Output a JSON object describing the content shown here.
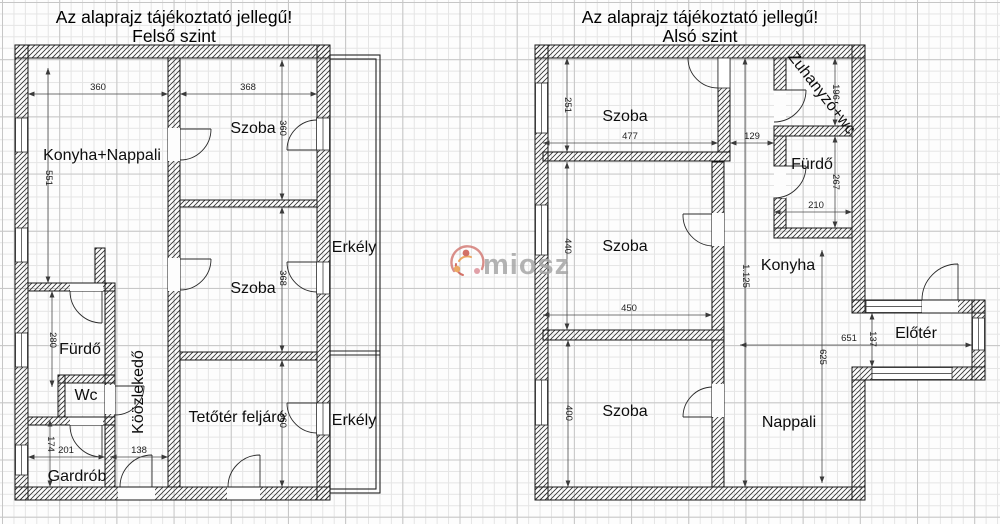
{
  "upper": {
    "disclaimer": "Az alaprajz tájékoztató jellegű!",
    "level": "Felső szint",
    "rooms": {
      "konyha_nappali": "Konyha+Nappali",
      "szoba_top": "Szoba",
      "szoba_mid": "Szoba",
      "erkely_top": "Erkély",
      "erkely_bottom": "Erkély",
      "furdo": "Fürdő",
      "wc": "Wc",
      "kozlekedo": "Köözlekedő",
      "tetoter": "Tetőtér feljáró",
      "gardrob": "Gardrób"
    },
    "dims": {
      "konyha_w": "360",
      "szoba_top_w": "368",
      "konyha_h": "551",
      "szoba_top_h": "360",
      "szoba_mid_h": "368",
      "tetoter_h": "360",
      "furdo_h": "280",
      "gardrob_h": "174",
      "gardrob_w": "201",
      "bejarat_w": "138"
    }
  },
  "lower": {
    "disclaimer": "Az alaprajz tájékoztató jellegű!",
    "level": "Alsó szint",
    "rooms": {
      "szoba_top": "Szoba",
      "szoba_mid": "Szoba",
      "szoba_bottom": "Szoba",
      "zuhanyzo": "Zuhanyzó+wc",
      "furdo": "Fürdő",
      "konyha": "Konyha",
      "eloter": "Előtér",
      "nappali": "Nappali"
    },
    "dims": {
      "szoba_top_h": "251",
      "szoba_top_w": "477",
      "folyoso_w": "129",
      "zuhanyzo_h": "196",
      "furdo_h": "267",
      "furdo_w": "210",
      "szoba_mid_h": "440",
      "szoba_mid_w": "450",
      "teljes_h": "1.125",
      "szoba_bottom_h": "400",
      "nappali_w": "651",
      "atjaro_h": "137",
      "nappali_h": "625"
    }
  },
  "watermark": {
    "brand": "miosz"
  }
}
